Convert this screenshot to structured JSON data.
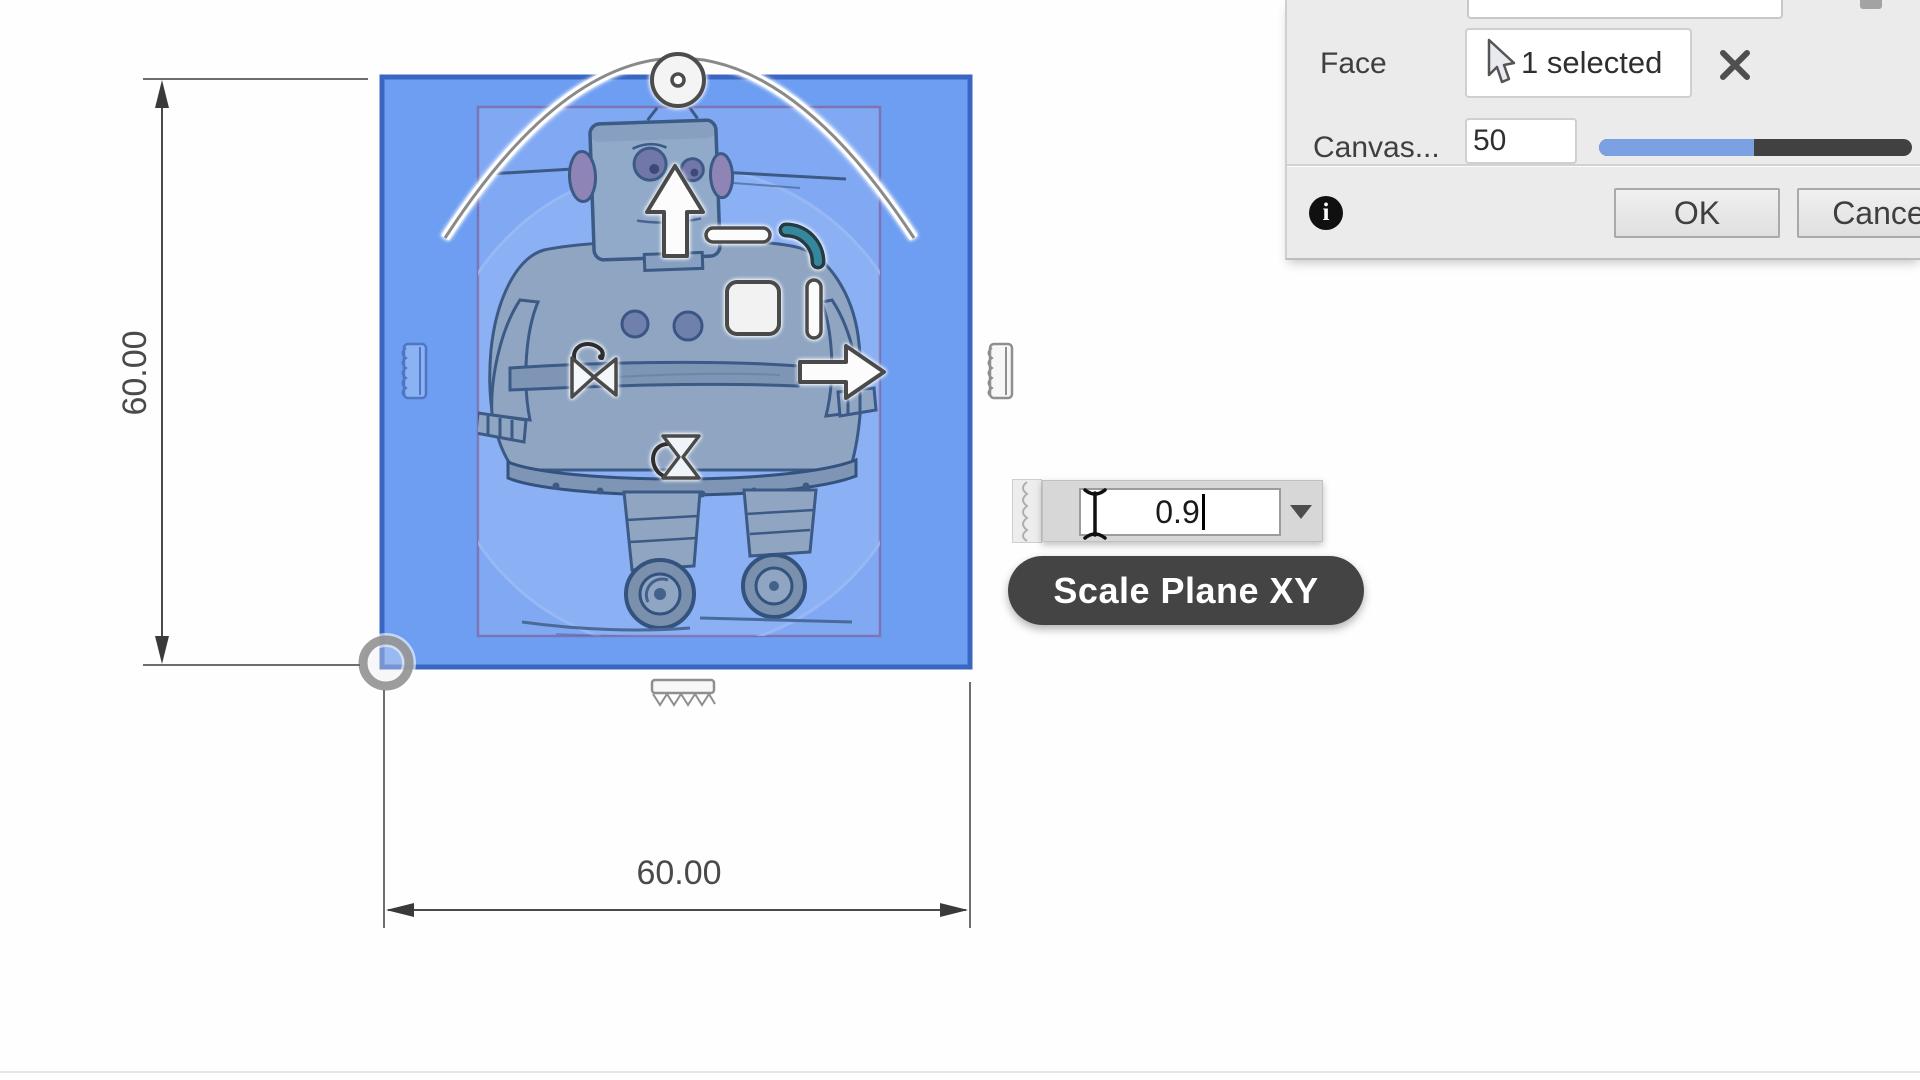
{
  "canvas_dialog": {
    "face_label": "Face",
    "face_value": "1 selected",
    "opacity_label": "Canvas...",
    "opacity_value": "50",
    "ok_label": "OK",
    "cancel_label": "Cancel"
  },
  "scale_overlay": {
    "value": "0.9",
    "tooltip": "Scale Plane XY"
  },
  "dimensions": {
    "width": "60.00",
    "height": "60.00"
  },
  "colors": {
    "face_fill": "#6d9ef1",
    "face_border": "#3a67c2",
    "canvas_fill": "#81a9f3",
    "canvas_border": "#7b74b6",
    "slider_accent": "#7ba1e2",
    "tooltip_bg": "#3a3a3a",
    "scale_handle_accent": "#36879b",
    "dialog_bg": "#ebebeb"
  },
  "icons": {
    "select_cursor": "pointer-arrow",
    "clear": "x-cross",
    "info": "i-circle",
    "dropdown": "triangle-down",
    "text_cursor": "i-beam",
    "rotate_handle": "knob-circle",
    "move_x": "arrow-right",
    "move_y": "arrow-up",
    "scale_xy": "corner-arc",
    "stretch_x": "bowtie",
    "stretch_y": "hourglass"
  }
}
